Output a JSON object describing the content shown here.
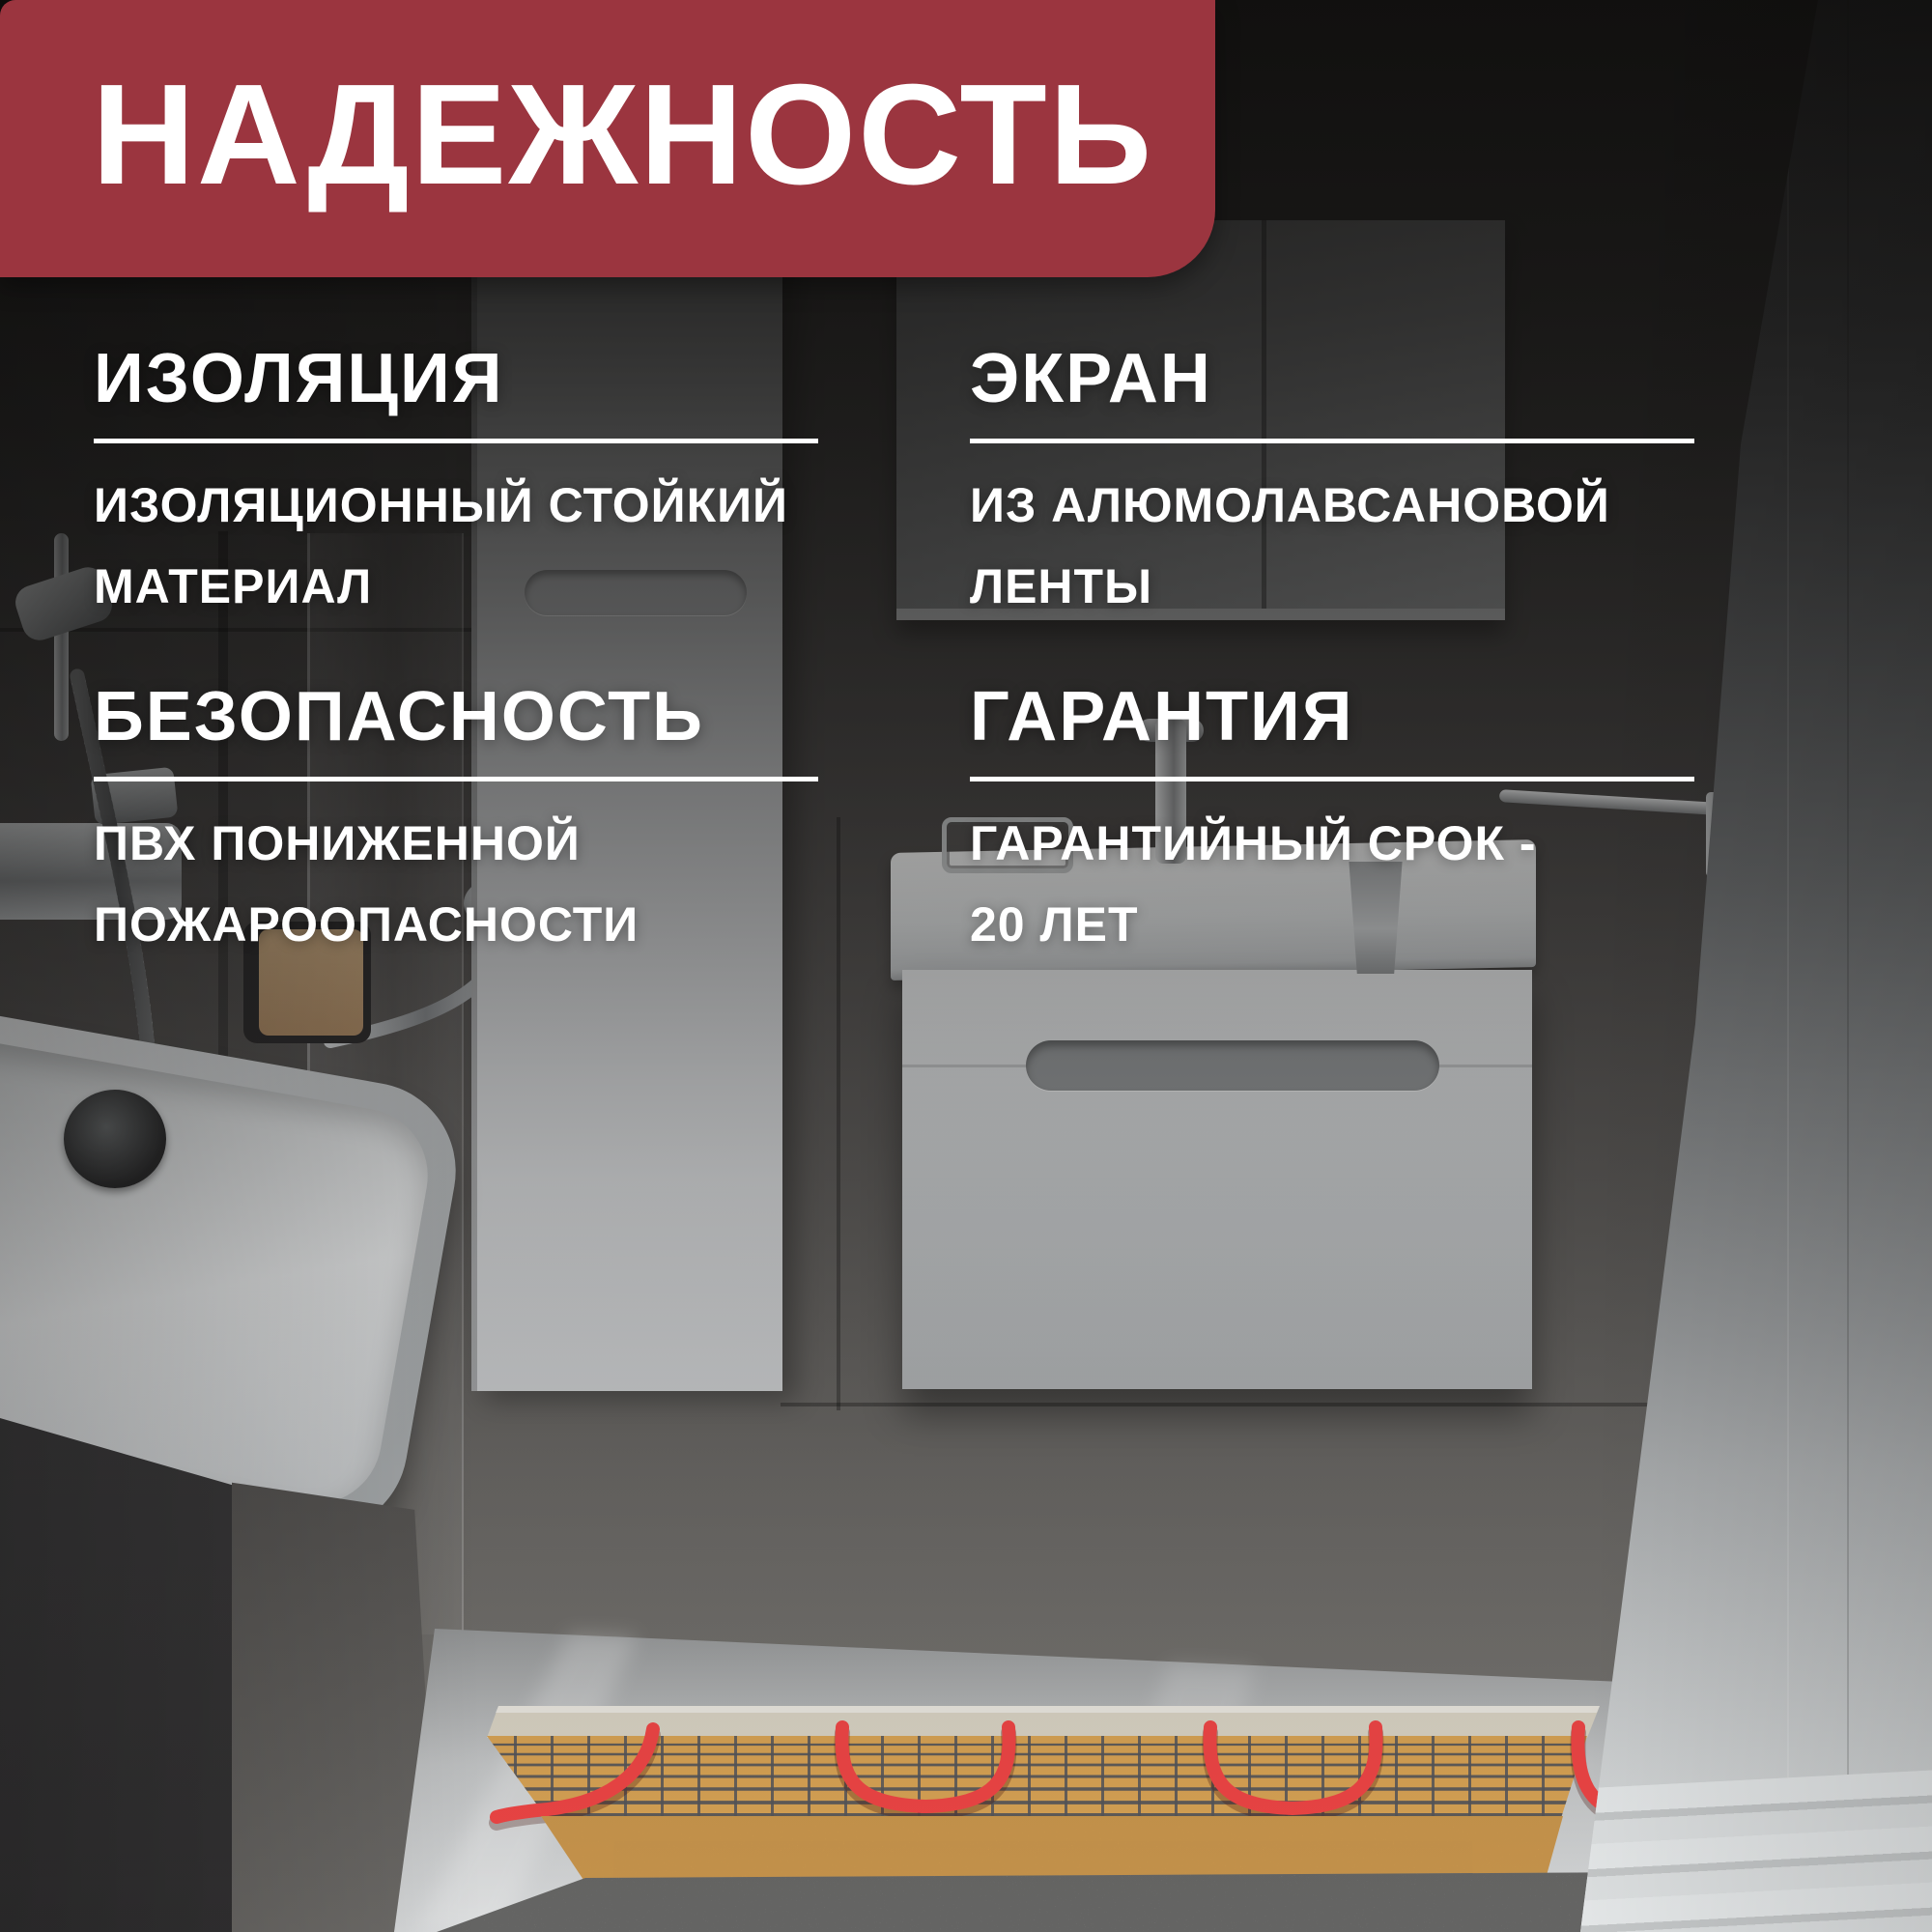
{
  "badge": {
    "title": "НАДЕЖНОСТЬ"
  },
  "features": [
    {
      "id": "insulation",
      "title": "ИЗОЛЯЦИЯ",
      "description": "ИЗОЛЯЦИОННЫЙ СТОЙКИЙ\nМАТЕРИАЛ"
    },
    {
      "id": "shield",
      "title": "ЭКРАН",
      "description": "ИЗ АЛЮМОЛАВСАНОВОЙ\nЛЕНТЫ"
    },
    {
      "id": "safety",
      "title": "БЕЗОПАСНОСТЬ",
      "description": "ПВХ ПОНИЖЕННОЙ\nПОЖАРООПАСНОСТИ"
    },
    {
      "id": "warranty",
      "title": "ГАРАНТИЯ",
      "description": "ГАРАНТИЙНЫЙ СРОК -\n20 ЛЕТ"
    }
  ],
  "theme": {
    "badge_bg": "#9b353f",
    "text_color": "#ffffff",
    "cable_red": "#ee4545",
    "cable_red_dark": "#c2333a",
    "mat_tan": "#d7a254",
    "mat_edge_orange": "#e9ae59",
    "mesh_gray": "#54555a",
    "underlay_cream": "#d8d2c3",
    "concrete_gray": "#a5a5a3",
    "floor_tile": "#c6c8c9"
  }
}
